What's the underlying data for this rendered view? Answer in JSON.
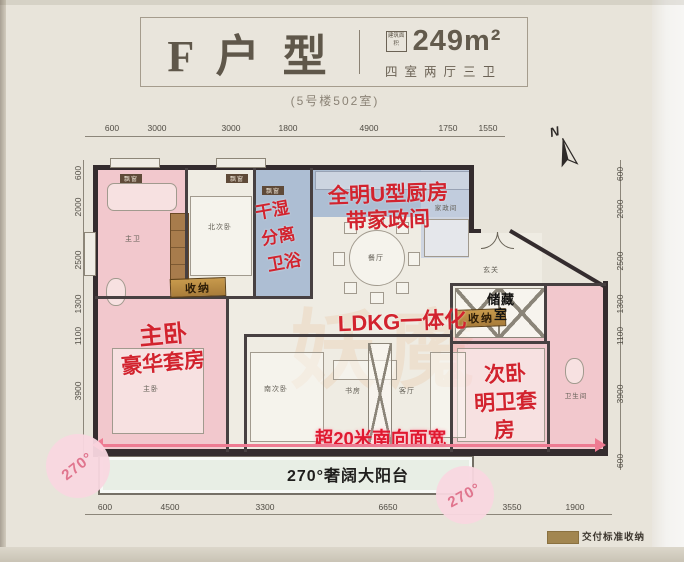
{
  "header": {
    "title": "F 户 型",
    "area_label": "建筑面积",
    "area_value": "249m²",
    "layout_spec": "四室两厅三卫",
    "subtitle": "(5号楼502室)"
  },
  "compass": {
    "north": "N"
  },
  "dims": {
    "top": [
      "600",
      "3000",
      "3000",
      "1800",
      "4900",
      "1750",
      "1550"
    ],
    "bottom": [
      "600",
      "4500",
      "3300",
      "6650",
      "3550",
      "1900"
    ],
    "left": [
      "600",
      "2000",
      "2500",
      "1300",
      "1100",
      "3900"
    ],
    "right": [
      "600",
      "2000",
      "2500",
      "1300",
      "1100",
      "3900",
      "600"
    ]
  },
  "rooms": {
    "master_bath": "主卫",
    "north_bedroom": "北次卧",
    "master_bedroom": "主卧",
    "south_bedroom": "南次卧",
    "study": "书房",
    "living": "客厅",
    "dining": "餐厅",
    "foyer": "玄关",
    "housekeeping": "家政间",
    "storage_room": "储藏室",
    "second_bath": "卫生间"
  },
  "annotations": {
    "kitchen_line1": "全明U型厨房",
    "kitchen_line2": "带家政间",
    "wet_dry": [
      "干湿",
      "分离",
      "卫浴"
    ],
    "ldkg": "LDKG一体化",
    "master_line1": "主卧",
    "master_line2": "豪华套房",
    "second_line1": "次卧",
    "second_line2": "明卫套",
    "second_line3": "房",
    "south_width": "超20米南向面宽",
    "balcony": "270°奢阔大阳台"
  },
  "tags": {
    "storage_left": "收纳",
    "storage_right": "收纳",
    "bay1": "飘窗",
    "bay2": "飘窗",
    "bay3": "飘窗"
  },
  "badges": {
    "left": "270°",
    "right": "270°"
  },
  "legend": {
    "delivery_storage": "交付标准收纳"
  },
  "watermark": "妖魔",
  "colors": {
    "annotation_red": "#d2232e",
    "suite_pink": "#f2c3c9",
    "bath_blue": "#9fb3cf",
    "tag_gold": "#b08940",
    "badge_pink": "#f9d9e2"
  }
}
